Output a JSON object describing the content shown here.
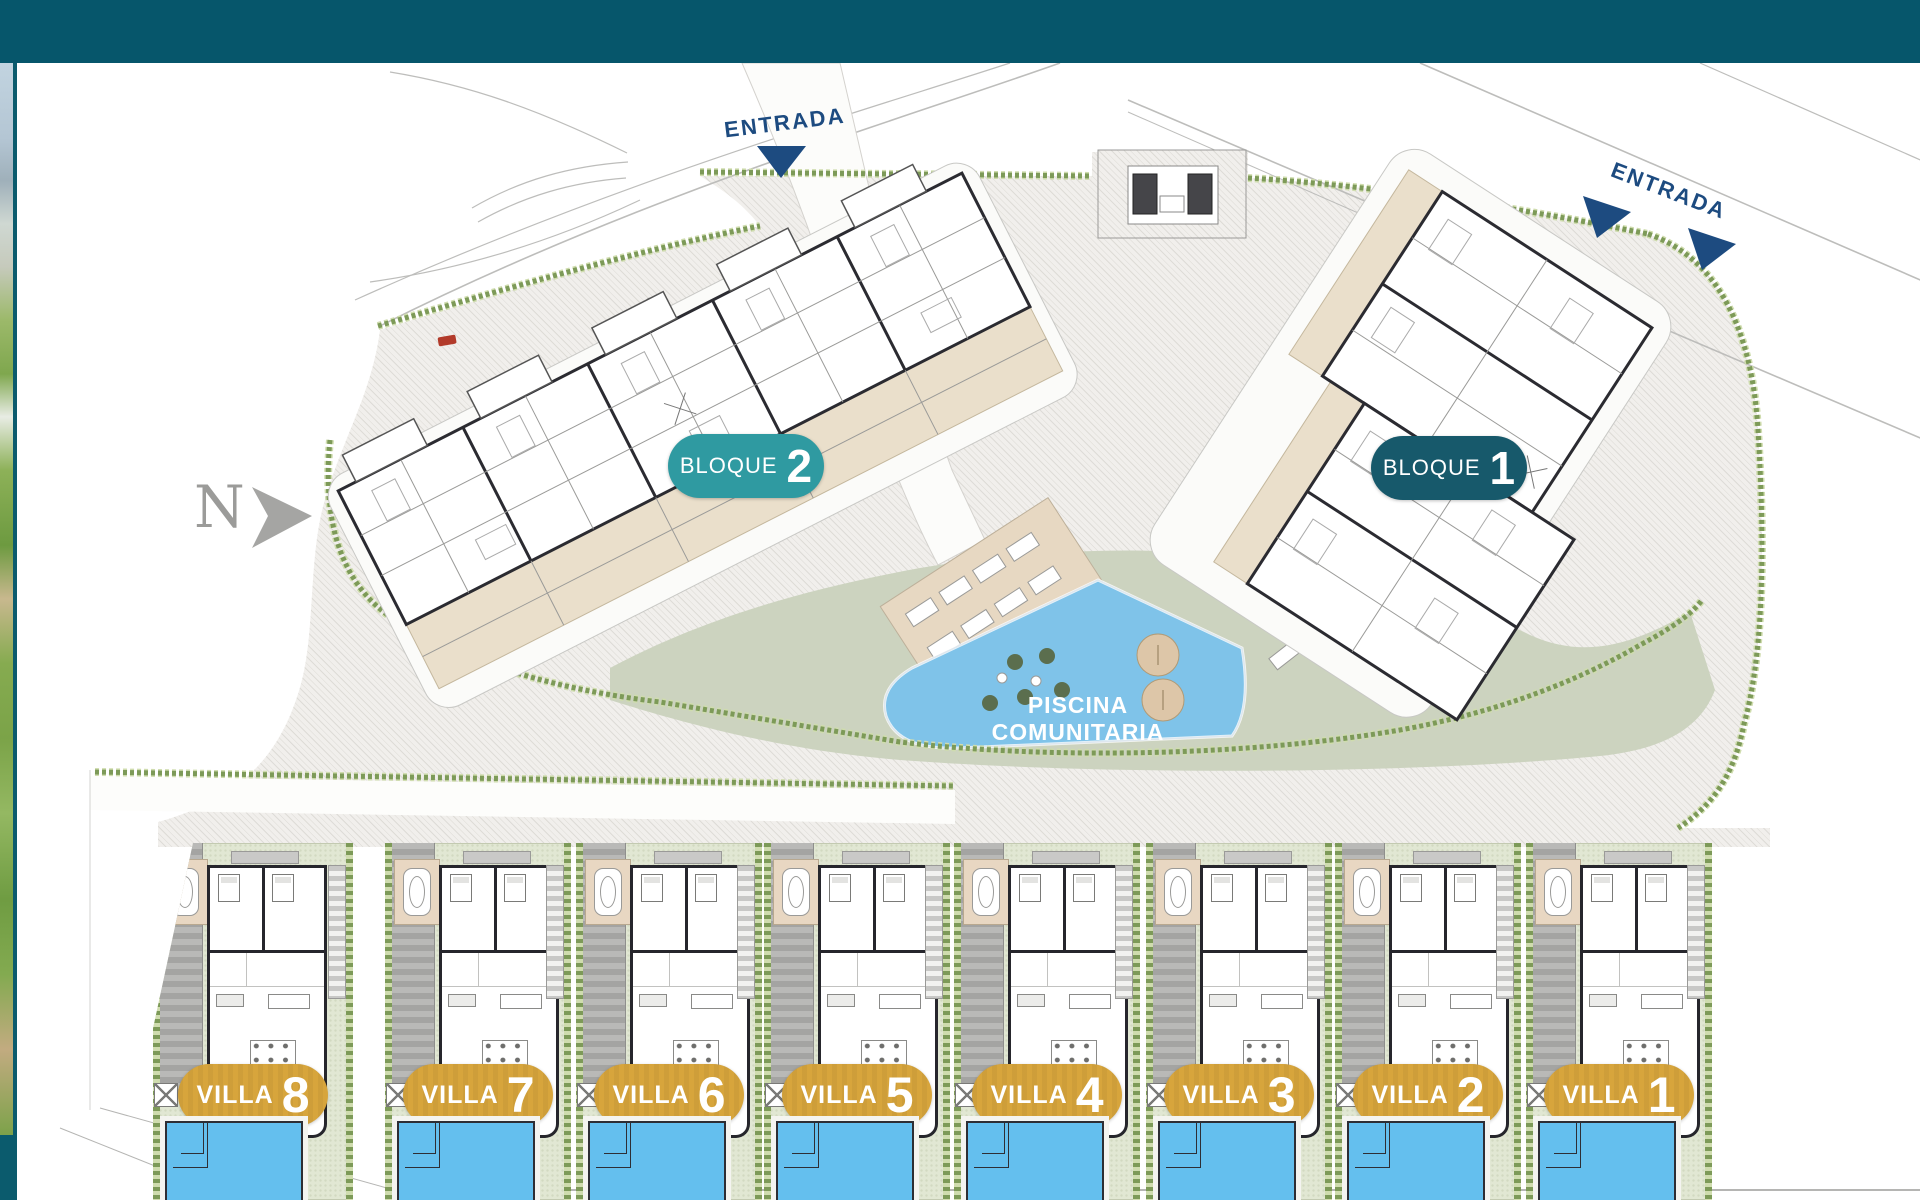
{
  "plan_title": "Residential site plan",
  "north": {
    "label": "N"
  },
  "entrances": [
    {
      "label": "ENTRADA"
    },
    {
      "label": "ENTRADA"
    }
  ],
  "blocks": [
    {
      "label": "BLOQUE",
      "number": "2",
      "badge_color": "#2f9aa1"
    },
    {
      "label": "BLOQUE",
      "number": "1",
      "badge_color": "#17596b"
    }
  ],
  "pool": {
    "label": "PISCINA COMUNITARIA",
    "color": "#7fc3e9"
  },
  "villas": [
    {
      "label": "VILLA",
      "number": "8"
    },
    {
      "label": "VILLA",
      "number": "7"
    },
    {
      "label": "VILLA",
      "number": "6"
    },
    {
      "label": "VILLA",
      "number": "5"
    },
    {
      "label": "VILLA",
      "number": "4"
    },
    {
      "label": "VILLA",
      "number": "3"
    },
    {
      "label": "VILLA",
      "number": "2"
    },
    {
      "label": "VILLA",
      "number": "1"
    }
  ],
  "colors": {
    "header": "#06566b",
    "entrance_text": "#1d4b80",
    "villa_badge_gold": "#d7a53c",
    "pool_blue": "#7fc3e9",
    "villa_pool_blue": "#64bfee",
    "garden_sage": "#ccd3bf",
    "hedge_green": "#7d9a58",
    "north_gray": "#9b9b99"
  }
}
